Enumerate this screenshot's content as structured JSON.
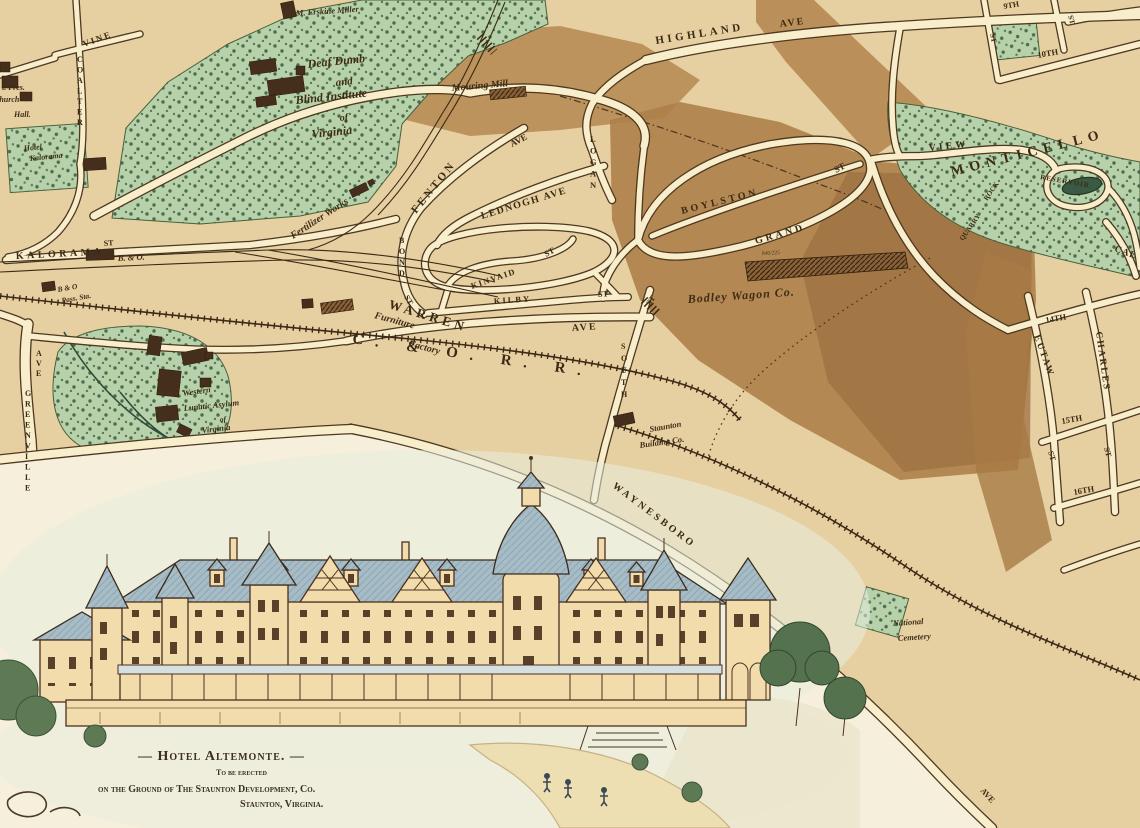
{
  "colors": {
    "paper": "#e6d0a2",
    "road_fill": "#f8eecb",
    "ink": "#4e3822",
    "park_green": "#b7d2aa",
    "hill_light": "#b78c54",
    "hill_dark": "#9d7040",
    "water": "#3a5a45",
    "hotel_wall": "#f2dcab",
    "hotel_roof": "#a6bcc6"
  },
  "map": {
    "labels": [
      {
        "id": "vine",
        "t": "VINE",
        "x": 84,
        "y": 47,
        "r": -20,
        "s": 9,
        "ls": 2,
        "st": "st"
      },
      {
        "id": "coalter",
        "t": "COALTER",
        "x": 77,
        "y": 62,
        "stack": true,
        "lh": 10.5,
        "s": 8,
        "st": "st"
      },
      {
        "id": "kalorama",
        "t": "KALORAMA",
        "x": 16,
        "y": 259,
        "r": -3,
        "s": 10,
        "ls": 3.5,
        "st": "st"
      },
      {
        "id": "kalorama-st",
        "t": "ST",
        "x": 104,
        "y": 246,
        "r": -5,
        "s": 8,
        "st": "st"
      },
      {
        "id": "greenville-ave",
        "t": "AVE",
        "x": 36,
        "y": 356,
        "stack": true,
        "lh": 10,
        "s": 8,
        "st": "st"
      },
      {
        "id": "greenville",
        "t": "GREENVILLE",
        "x": 25,
        "y": 396,
        "stack": true,
        "lh": 10.5,
        "s": 8,
        "st": "st"
      },
      {
        "id": "highland",
        "t": "HIGHLAND",
        "x": 656,
        "y": 44,
        "r": -9,
        "s": 11,
        "ls": 3.5,
        "st": "st"
      },
      {
        "id": "highland-ave",
        "t": "AVE",
        "x": 780,
        "y": 27,
        "r": -7,
        "s": 10,
        "ls": 2,
        "st": "st"
      },
      {
        "id": "fenton",
        "t": "FENTON",
        "x": 416,
        "y": 214,
        "r": -51,
        "s": 11,
        "ls": 3,
        "st": "st"
      },
      {
        "id": "fenton-ave",
        "t": "AVE",
        "x": 512,
        "y": 147,
        "r": -28,
        "s": 9,
        "st": "st"
      },
      {
        "id": "lednogh",
        "t": "LEDNOGH AVE",
        "x": 482,
        "y": 219,
        "r": -17,
        "s": 10,
        "ls": 1.5,
        "st": "st"
      },
      {
        "id": "logan",
        "t": "LOGAN",
        "x": 590,
        "y": 142,
        "stack": true,
        "lh": 11.5,
        "s": 8.5,
        "st": "st"
      },
      {
        "id": "boylston",
        "t": "BOYLSTON",
        "x": 682,
        "y": 214,
        "r": -14,
        "s": 10,
        "ls": 3,
        "st": "st"
      },
      {
        "id": "boylston-st",
        "t": "ST",
        "x": 836,
        "y": 173,
        "r": -28,
        "s": 9,
        "st": "st"
      },
      {
        "id": "grand",
        "t": "GRAND",
        "x": 756,
        "y": 244,
        "r": -16,
        "s": 10,
        "ls": 3,
        "st": "st"
      },
      {
        "id": "view",
        "t": "VIEW",
        "x": 929,
        "y": 151,
        "r": -6,
        "s": 10,
        "ls": 3,
        "st": "st"
      },
      {
        "id": "ninth",
        "t": "9TH",
        "x": 1004,
        "y": 9,
        "r": -10,
        "s": 8,
        "st": "st"
      },
      {
        "id": "tenth",
        "t": "10TH",
        "x": 1038,
        "y": 58,
        "r": -10,
        "s": 8.5,
        "st": "st"
      },
      {
        "id": "st-tr1",
        "t": "ST",
        "x": 1068,
        "y": 16,
        "r": 75,
        "s": 7.5,
        "st": "st"
      },
      {
        "id": "st-tr2",
        "t": "ST",
        "x": 990,
        "y": 34,
        "r": 78,
        "s": 7.5,
        "st": "st"
      },
      {
        "id": "kinvaid",
        "t": "KINVAID",
        "x": 472,
        "y": 289,
        "r": -19,
        "s": 8.5,
        "ls": 1.5,
        "st": "st"
      },
      {
        "id": "kinvaid-st",
        "t": "ST",
        "x": 546,
        "y": 257,
        "r": -28,
        "s": 8.5,
        "st": "st"
      },
      {
        "id": "kilby",
        "t": "KILBY",
        "x": 494,
        "y": 304,
        "r": -4,
        "s": 8.5,
        "ls": 2,
        "st": "st"
      },
      {
        "id": "kilby-st",
        "t": "ST",
        "x": 598,
        "y": 297,
        "r": -4,
        "s": 8.5,
        "st": "st"
      },
      {
        "id": "bond",
        "t": "BOND",
        "x": 399,
        "y": 243,
        "stack": true,
        "lh": 11,
        "s": 8,
        "st": "st"
      },
      {
        "id": "bond-st",
        "t": "ST",
        "x": 404,
        "y": 297,
        "r": 60,
        "s": 8,
        "st": "st"
      },
      {
        "id": "warren",
        "t": "WARREN",
        "x": 388,
        "y": 308,
        "r": 17,
        "s": 13,
        "ls": 4,
        "st": "st"
      },
      {
        "id": "warren-ave",
        "t": "AVE",
        "x": 572,
        "y": 331,
        "r": -4,
        "s": 10,
        "ls": 2,
        "st": "st"
      },
      {
        "id": "south",
        "t": "SOUTH",
        "x": 621,
        "y": 349,
        "stack": true,
        "lh": 12,
        "s": 8,
        "st": "st"
      },
      {
        "id": "south-st",
        "t": "ST",
        "x": 650,
        "y": 306,
        "r": -55,
        "s": 8,
        "st": "st"
      },
      {
        "id": "co-rr",
        "t": "C. & O. R. R.",
        "x": 352,
        "y": 343,
        "r": 8,
        "s": 15,
        "ls": 12,
        "st": "st"
      },
      {
        "id": "waynesboro",
        "t": "WAYNESBORO",
        "x": 612,
        "y": 487,
        "r": 37,
        "s": 10,
        "ls": 3,
        "st": "st"
      },
      {
        "id": "ave-bottom",
        "t": "AVE",
        "x": 980,
        "y": 791,
        "r": 48,
        "s": 8.5,
        "st": "st"
      },
      {
        "id": "fourteenth",
        "t": "14TH",
        "x": 1046,
        "y": 323,
        "r": -10,
        "s": 8.5,
        "st": "st"
      },
      {
        "id": "eutaw",
        "t": "EUTAW",
        "x": 1034,
        "y": 336,
        "r": 70,
        "s": 9.5,
        "ls": 2,
        "st": "st"
      },
      {
        "id": "eutaw-st",
        "t": "ST",
        "x": 1048,
        "y": 452,
        "r": 72,
        "s": 8,
        "st": "st"
      },
      {
        "id": "charles",
        "t": "CHARLES",
        "x": 1096,
        "y": 332,
        "r": 82,
        "s": 9.5,
        "ls": 2,
        "st": "st"
      },
      {
        "id": "charles-st",
        "t": "ST",
        "x": 1104,
        "y": 448,
        "r": 75,
        "s": 8,
        "st": "st"
      },
      {
        "id": "fifteenth",
        "t": "15TH",
        "x": 1062,
        "y": 424,
        "r": -10,
        "s": 8.5,
        "st": "st"
      },
      {
        "id": "sixteenth",
        "t": "16TH",
        "x": 1074,
        "y": 495,
        "r": -10,
        "s": 8.5,
        "st": "st"
      },
      {
        "id": "cal",
        "t": "CAL",
        "x": 1114,
        "y": 251,
        "r": 20,
        "s": 9.5,
        "ls": 1,
        "st": "st"
      },
      {
        "id": "monticello",
        "t": "MONTICELLO",
        "x": 952,
        "y": 176,
        "r": -14,
        "s": 14,
        "ls": 6,
        "st": "st"
      },
      {
        "id": "reservoir",
        "t": "RESERVOIR",
        "x": 1040,
        "y": 179,
        "r": 10,
        "s": 7,
        "ls": 1,
        "st": "st"
      },
      {
        "id": "rock",
        "t": "ROCK",
        "x": 987,
        "y": 201,
        "r": -55,
        "s": 7,
        "st": "st"
      },
      {
        "id": "quarry",
        "t": "QUARRY",
        "x": 963,
        "y": 241,
        "r": -55,
        "s": 7,
        "st": "st"
      },
      {
        "id": "erskine",
        "t": "M. Erskine Miller",
        "x": 296,
        "y": 16,
        "r": -4,
        "s": 8.5,
        "st": "pl"
      },
      {
        "id": "institute-1",
        "t": "Deaf Dumb",
        "x": 308,
        "y": 68,
        "r": -6,
        "s": 12,
        "st": "pl"
      },
      {
        "id": "institute-2",
        "t": "and",
        "x": 336,
        "y": 86,
        "r": -6,
        "s": 11,
        "st": "pl"
      },
      {
        "id": "institute-3",
        "t": "Blind Institute",
        "x": 296,
        "y": 104,
        "r": -6,
        "s": 12,
        "st": "pl"
      },
      {
        "id": "institute-4",
        "t": "of",
        "x": 340,
        "y": 121,
        "r": -6,
        "s": 10,
        "st": "pl"
      },
      {
        "id": "institute-5",
        "t": "Virginia",
        "x": 312,
        "y": 138,
        "r": -6,
        "s": 12,
        "st": "pl"
      },
      {
        "id": "hotel-kalorama-1",
        "t": "Hotel",
        "x": 24,
        "y": 151,
        "r": -6,
        "s": 8,
        "st": "pl"
      },
      {
        "id": "hotel-kalorama-2",
        "t": "Kalorama",
        "x": 30,
        "y": 161,
        "r": -6,
        "s": 8,
        "st": "pl"
      },
      {
        "id": "pres-1",
        "t": "t. Pres.",
        "x": 2,
        "y": 90,
        "s": 8,
        "st": "pl"
      },
      {
        "id": "pres-2",
        "t": "Church",
        "x": -6,
        "y": 102,
        "s": 8,
        "st": "pl"
      },
      {
        "id": "pres-3",
        "t": "Hall.",
        "x": 14,
        "y": 117,
        "s": 8,
        "st": "pl"
      },
      {
        "id": "mouring-mill",
        "t": "Mouring Mill",
        "x": 452,
        "y": 91,
        "r": -5,
        "s": 10,
        "st": "pl"
      },
      {
        "id": "fertilizer",
        "t": "Fertilizer Works",
        "x": 293,
        "y": 239,
        "r": -33,
        "s": 10,
        "st": "pl"
      },
      {
        "id": "b-and-o",
        "t": "B. & O.",
        "x": 118,
        "y": 261,
        "r": -3,
        "s": 8.5,
        "st": "pl"
      },
      {
        "id": "bo-pass-1",
        "t": "B & O",
        "x": 58,
        "y": 292,
        "r": -10,
        "s": 7.5,
        "st": "pl"
      },
      {
        "id": "bo-pass-2",
        "t": "Pass. Sta.",
        "x": 62,
        "y": 303,
        "r": -10,
        "s": 7.5,
        "st": "pl"
      },
      {
        "id": "furniture-1",
        "t": "Furniture",
        "x": 374,
        "y": 318,
        "r": 15,
        "s": 10,
        "st": "pl"
      },
      {
        "id": "furniture-2",
        "t": "Factory",
        "x": 408,
        "y": 346,
        "r": 15,
        "s": 10,
        "st": "pl"
      },
      {
        "id": "bodley",
        "t": "Bodley Wagon Co.",
        "x": 688,
        "y": 303,
        "r": -4,
        "s": 12,
        "ls": 1,
        "st": "pl"
      },
      {
        "id": "bodley-dim",
        "t": "840/225",
        "x": 762,
        "y": 255,
        "r": -3,
        "s": 5.5,
        "st": "tiny"
      },
      {
        "id": "staunton-bldg-1",
        "t": "Staunton",
        "x": 650,
        "y": 432,
        "r": -10,
        "s": 8.5,
        "st": "pl"
      },
      {
        "id": "staunton-bldg-2",
        "t": "Building Co.",
        "x": 640,
        "y": 448,
        "r": -8,
        "s": 8.5,
        "st": "pl"
      },
      {
        "id": "asylum-1",
        "t": "Western",
        "x": 183,
        "y": 396,
        "r": -8,
        "s": 8.5,
        "st": "pl"
      },
      {
        "id": "asylum-2",
        "t": "Lunatic Asylum",
        "x": 184,
        "y": 411,
        "r": -6,
        "s": 8.5,
        "st": "pl"
      },
      {
        "id": "asylum-3",
        "t": "of",
        "x": 220,
        "y": 422,
        "r": -6,
        "s": 7.5,
        "st": "pl"
      },
      {
        "id": "asylum-4",
        "t": "Virginia",
        "x": 202,
        "y": 433,
        "r": -6,
        "s": 8.5,
        "st": "pl"
      },
      {
        "id": "cemetery-1",
        "t": "National",
        "x": 893,
        "y": 626,
        "r": -4,
        "s": 8.5,
        "st": "pl"
      },
      {
        "id": "cemetery-2",
        "t": "Cemetery",
        "x": 898,
        "y": 641,
        "r": -4,
        "s": 8.5,
        "st": "pl"
      },
      {
        "id": "caption-1",
        "t": "— Hotel Altemonte. —",
        "x": 138,
        "y": 760,
        "s": 14,
        "ls": 1,
        "st": "cap"
      },
      {
        "id": "caption-2",
        "t": "To be erected",
        "x": 216,
        "y": 775,
        "s": 8,
        "st": "cap"
      },
      {
        "id": "caption-3",
        "t": "on the Ground of The Staunton Development, Co.",
        "x": 98,
        "y": 792,
        "s": 10,
        "st": "cap"
      },
      {
        "id": "caption-4",
        "t": "Staunton, Virginia.",
        "x": 240,
        "y": 807,
        "s": 10,
        "st": "cap"
      }
    ]
  }
}
